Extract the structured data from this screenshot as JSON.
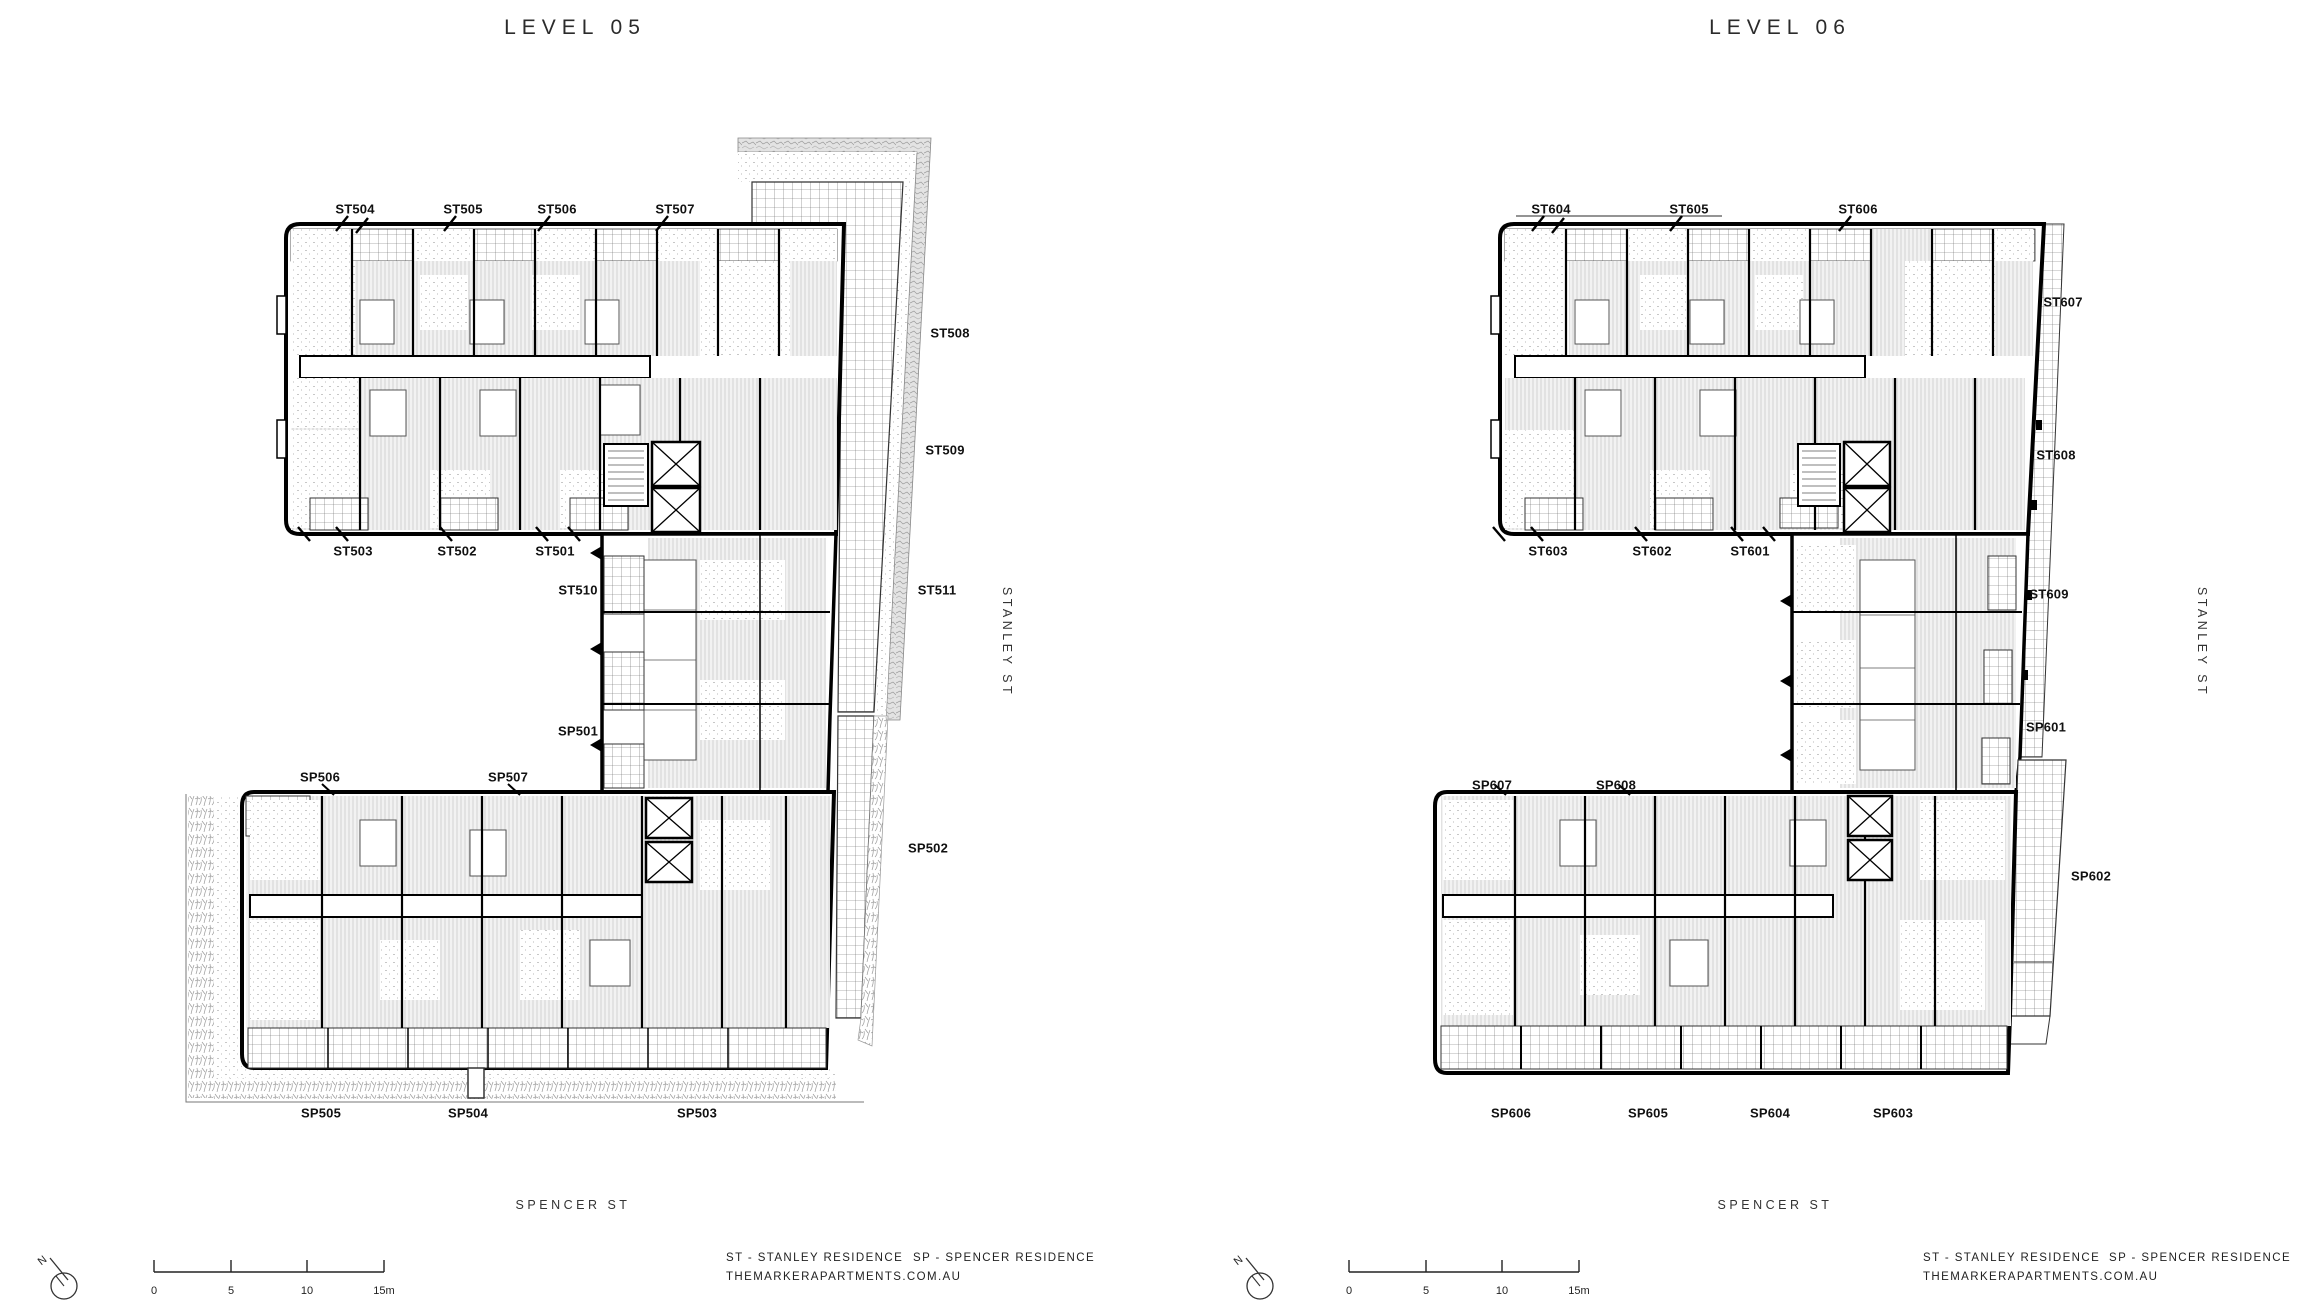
{
  "plans": [
    {
      "title": "LEVEL 05",
      "streets": {
        "right": "STANLEY ST",
        "bottom": "SPENCER ST"
      },
      "units": {
        "ST504": "ST504",
        "ST505": "ST505",
        "ST506": "ST506",
        "ST507": "ST507",
        "ST508": "ST508",
        "ST509": "ST509",
        "ST511": "ST511",
        "ST503": "ST503",
        "ST502": "ST502",
        "ST501": "ST501",
        "ST510": "ST510",
        "SP501": "SP501",
        "SP506": "SP506",
        "SP507": "SP507",
        "SP502": "SP502",
        "SP505": "SP505",
        "SP504": "SP504",
        "SP503": "SP503"
      }
    },
    {
      "title": "LEVEL 06",
      "streets": {
        "right": "STANLEY ST",
        "bottom": "SPENCER ST"
      },
      "units": {
        "ST604": "ST604",
        "ST605": "ST605",
        "ST606": "ST606",
        "ST607": "ST607",
        "ST608": "ST608",
        "ST609": "ST609",
        "ST603": "ST603",
        "ST602": "ST602",
        "ST601": "ST601",
        "SP607": "SP607",
        "SP608": "SP608",
        "SP601": "SP601",
        "SP602": "SP602",
        "SP606": "SP606",
        "SP605": "SP605",
        "SP604": "SP604",
        "SP603": "SP603"
      }
    }
  ],
  "footer": {
    "north_label": "N",
    "scale": {
      "t0": "0",
      "t5": "5",
      "t10": "10",
      "t15": "15m"
    },
    "legend": {
      "st": "ST - STANLEY RESIDENCE",
      "sp": "SP - SPENCER RESIDENCE",
      "website": "THEMARKERAPARTMENTS.COM.AU"
    }
  },
  "colors": {
    "walls": "#000000",
    "text": "#1a1a1a",
    "hatch": "#8a8a8a"
  }
}
